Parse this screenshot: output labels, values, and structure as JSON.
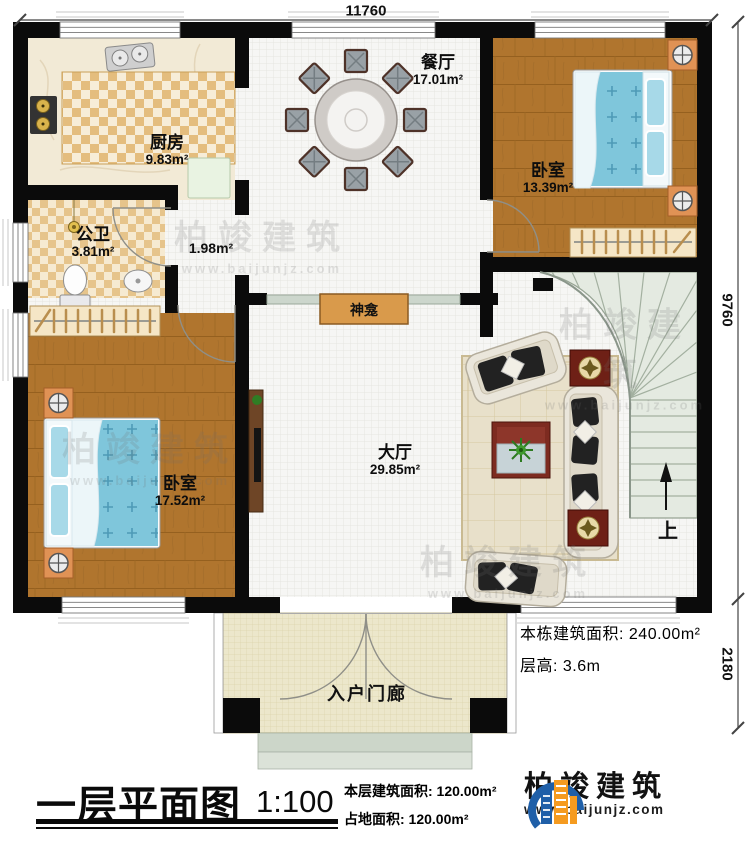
{
  "dimensions": {
    "width_top": "11760",
    "height_right_main": "9760",
    "height_right_porch": "2180"
  },
  "rooms": {
    "kitchen": {
      "name": "厨房",
      "area": "9.83m²"
    },
    "dining_room": {
      "name": "餐厅",
      "area": "17.01m²"
    },
    "bedroom_upper": {
      "name": "卧室",
      "area": "13.39m²"
    },
    "bathroom": {
      "name": "公卫",
      "area": "3.81m²"
    },
    "corridor": {
      "area": "1.98m²"
    },
    "bedroom_lower": {
      "name": "卧室",
      "area": "17.52m²"
    },
    "living_hall": {
      "name": "大厅",
      "area": "29.85m²"
    },
    "shrine": {
      "name": "神龛"
    },
    "entry_porch": {
      "name": "入户门廊"
    },
    "stairs": {
      "up_label": "上"
    }
  },
  "side_notes": {
    "building_total_area": "本栋建筑面积: 240.00m²",
    "floor_height": "层高: 3.6m"
  },
  "footer": {
    "plan_title": "一层平面图",
    "scale": "1:100",
    "floor_area": "本层建筑面积: 120.00m²",
    "site_area": "占地面积: 120.00m²"
  },
  "brand": {
    "name": "柏竣建筑",
    "website": "www.baijunjz.com"
  },
  "watermark": {
    "text": "柏竣建筑",
    "website": "www.baijunjz.com"
  }
}
